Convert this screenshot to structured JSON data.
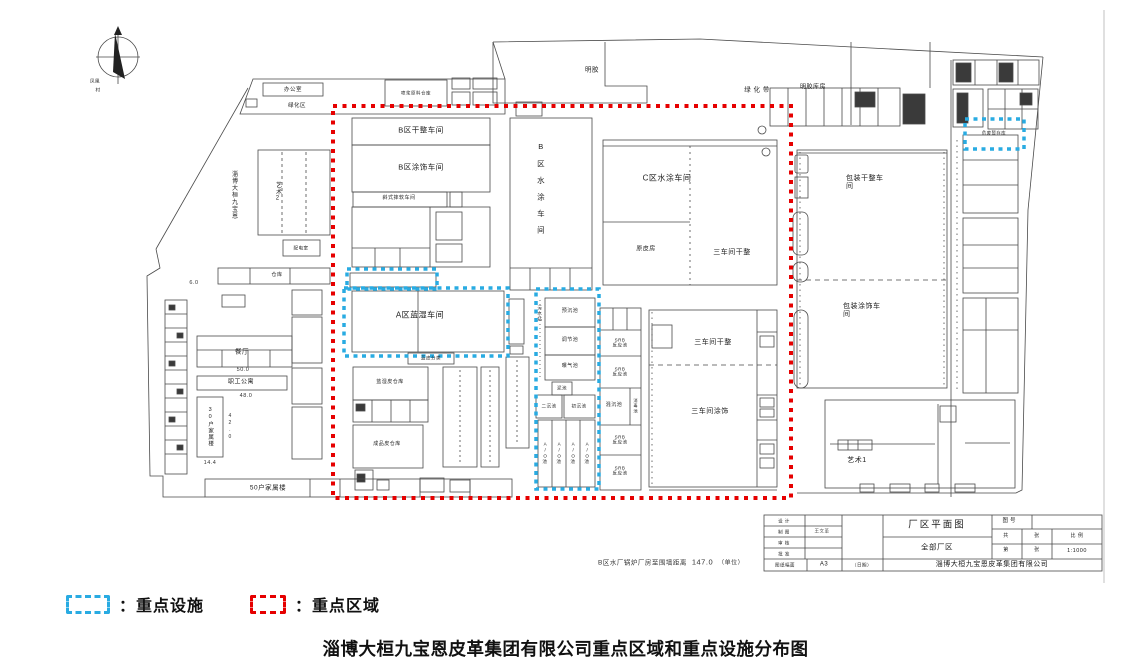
{
  "page": {
    "title": "淄博大桓九宝恩皮革集团有限公司重点区域和重点设施分布图",
    "colors": {
      "key_area": "#e60000",
      "key_facility": "#29abe2",
      "line": "#4a4a4a"
    }
  },
  "legend": {
    "sep": "：",
    "facility": "重点设施",
    "area": "重点区域"
  },
  "compass": {
    "village_line1": "凤凰",
    "village_line2": "村"
  },
  "labels": {
    "office": "办公室",
    "green_zone": "绿化区",
    "road": "淄博大桓九宝恩",
    "art2": "艺术2",
    "power": "配电室",
    "storehouse": "仓库",
    "canteen": "餐厅",
    "staff_apt": "职工公寓",
    "fam30": "30户家属楼",
    "fam50": "50户家属楼",
    "spray_store": "喷浆原料仓库",
    "b_dry": "B区干整车间",
    "b_coat": "B区涂饰车间",
    "mill": "斜式摔软车间",
    "b_water": "B区水涂车间",
    "gelatin": "明胶",
    "green_belt": "绿 化 带",
    "gelatin_store": "明胶库房",
    "c_water": "C区水涂车间",
    "rawhide": "原皮房",
    "ws3_dry_c": "三车间干整",
    "ws3_dry": "三车间干整",
    "ws3_coat": "三车间涂饰",
    "a_wetblue": "A区蓝湿车间",
    "blue_sort": "蓝皮分类",
    "wetblue_store": "蓝湿皮仓库",
    "finished_store": "成品皮仓库",
    "sewage": "污水站",
    "pool_pre": "预沉池",
    "pool_adj": "调节池",
    "pool_aer": "曝气池",
    "pool_mud": "泥池",
    "pool_sec": "二沉池",
    "pool_pri": "初沉池",
    "pool_ao": "A/O池",
    "srb_l1": "SRB",
    "srb_l2": "反应池",
    "pool_mix": "混沉池",
    "pool_dis": "消毒池",
    "pack_dry": "包装干整车间",
    "pack_coat": "包装涂饰车间",
    "art1": "艺术1",
    "hazwaste": "危废暂存库"
  },
  "dims": {
    "d6_0": "6.0",
    "d50_0": "50.0",
    "d48_0": "48.0",
    "d42_0": "42.0",
    "d14_4": "14.4"
  },
  "note": {
    "text": "B区水厂锅炉厂房至围墙距离",
    "value": "147.0",
    "unit": "（单位）"
  },
  "title_block": {
    "design": "设 计",
    "draft": "制 图",
    "draft_name": "王文革",
    "check": "审 核",
    "approve": "批 准",
    "size_label": "图纸幅面",
    "size_value": "A3",
    "date_label": "（日期）",
    "drawing_name": "厂区平面图",
    "scope": "全部厂区",
    "company": "淄博大桓九宝恩皮革集团有限公司",
    "no_label": "图号",
    "total_label": "共",
    "sheet_label": "张",
    "scale_label": "比 例",
    "index_label": "第",
    "sheet_label2": "张",
    "scale_value": "1:1000"
  }
}
